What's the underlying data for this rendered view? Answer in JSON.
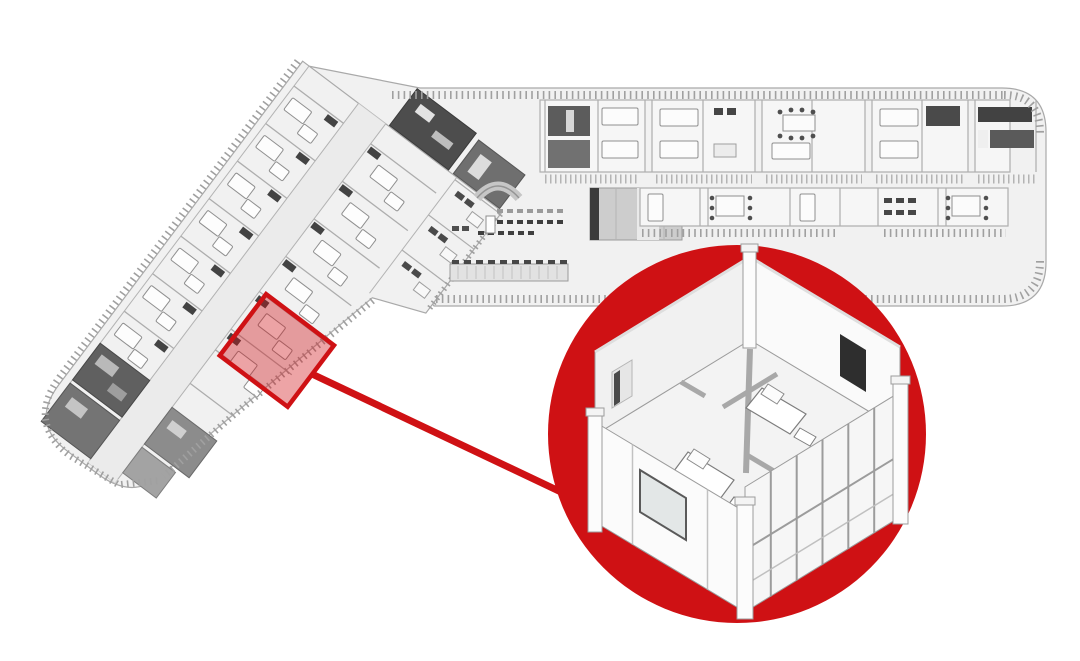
{
  "figure": {
    "kind": "axonometric-floor-plan-with-detail-callout",
    "background_color": "#ffffff"
  },
  "colors": {
    "accent_red": "#cf1114",
    "highlight_fill_opacity": "0.38",
    "building_fill": "#f1f1f1",
    "room_band_fill": "#f6f6f6",
    "corridor_fill": "#ebebeb",
    "wall_line": "#9c9c9c",
    "divider_line": "#aeaeae",
    "dark_fixture": "#464646",
    "dark_room": "#5c5c5c",
    "railing_gray": "#a0a0a0",
    "detail_wall_fill": "#f8f8f8",
    "detail_floor_fill": "#f3f3f3",
    "tv_panel": "#2e2e2e"
  },
  "overview": {
    "name": "l-shaped-ward-floor-plan",
    "left_wing": {
      "name": "left-ward-wing",
      "rotation_deg": 37,
      "features": [
        "patient-rooms",
        "central-corridor",
        "bathroom-annex",
        "stair-cores",
        "dark-service-rooms",
        "balcony-railing"
      ]
    },
    "right_wing": {
      "name": "right-ward-wing",
      "rotation_deg": 0,
      "features": [
        "patient-room-row",
        "middle-room-row",
        "atrium-hall",
        "reception-desk",
        "waiting-seats",
        "service-counter",
        "elevator-core",
        "balcony-railing"
      ]
    }
  },
  "highlight": {
    "name": "selected-room-module",
    "shape": "rotated-square"
  },
  "leader": {
    "name": "callout-leader-line"
  },
  "callout": {
    "name": "room-detail-callout",
    "shape": "circle",
    "detail": {
      "name": "two-bed-patient-room-cutaway",
      "elements": [
        "bathroom-partition",
        "patient-bed",
        "second-bed",
        "sofa",
        "tv-panel",
        "window-wall",
        "door-opening",
        "corner-posts"
      ]
    }
  }
}
